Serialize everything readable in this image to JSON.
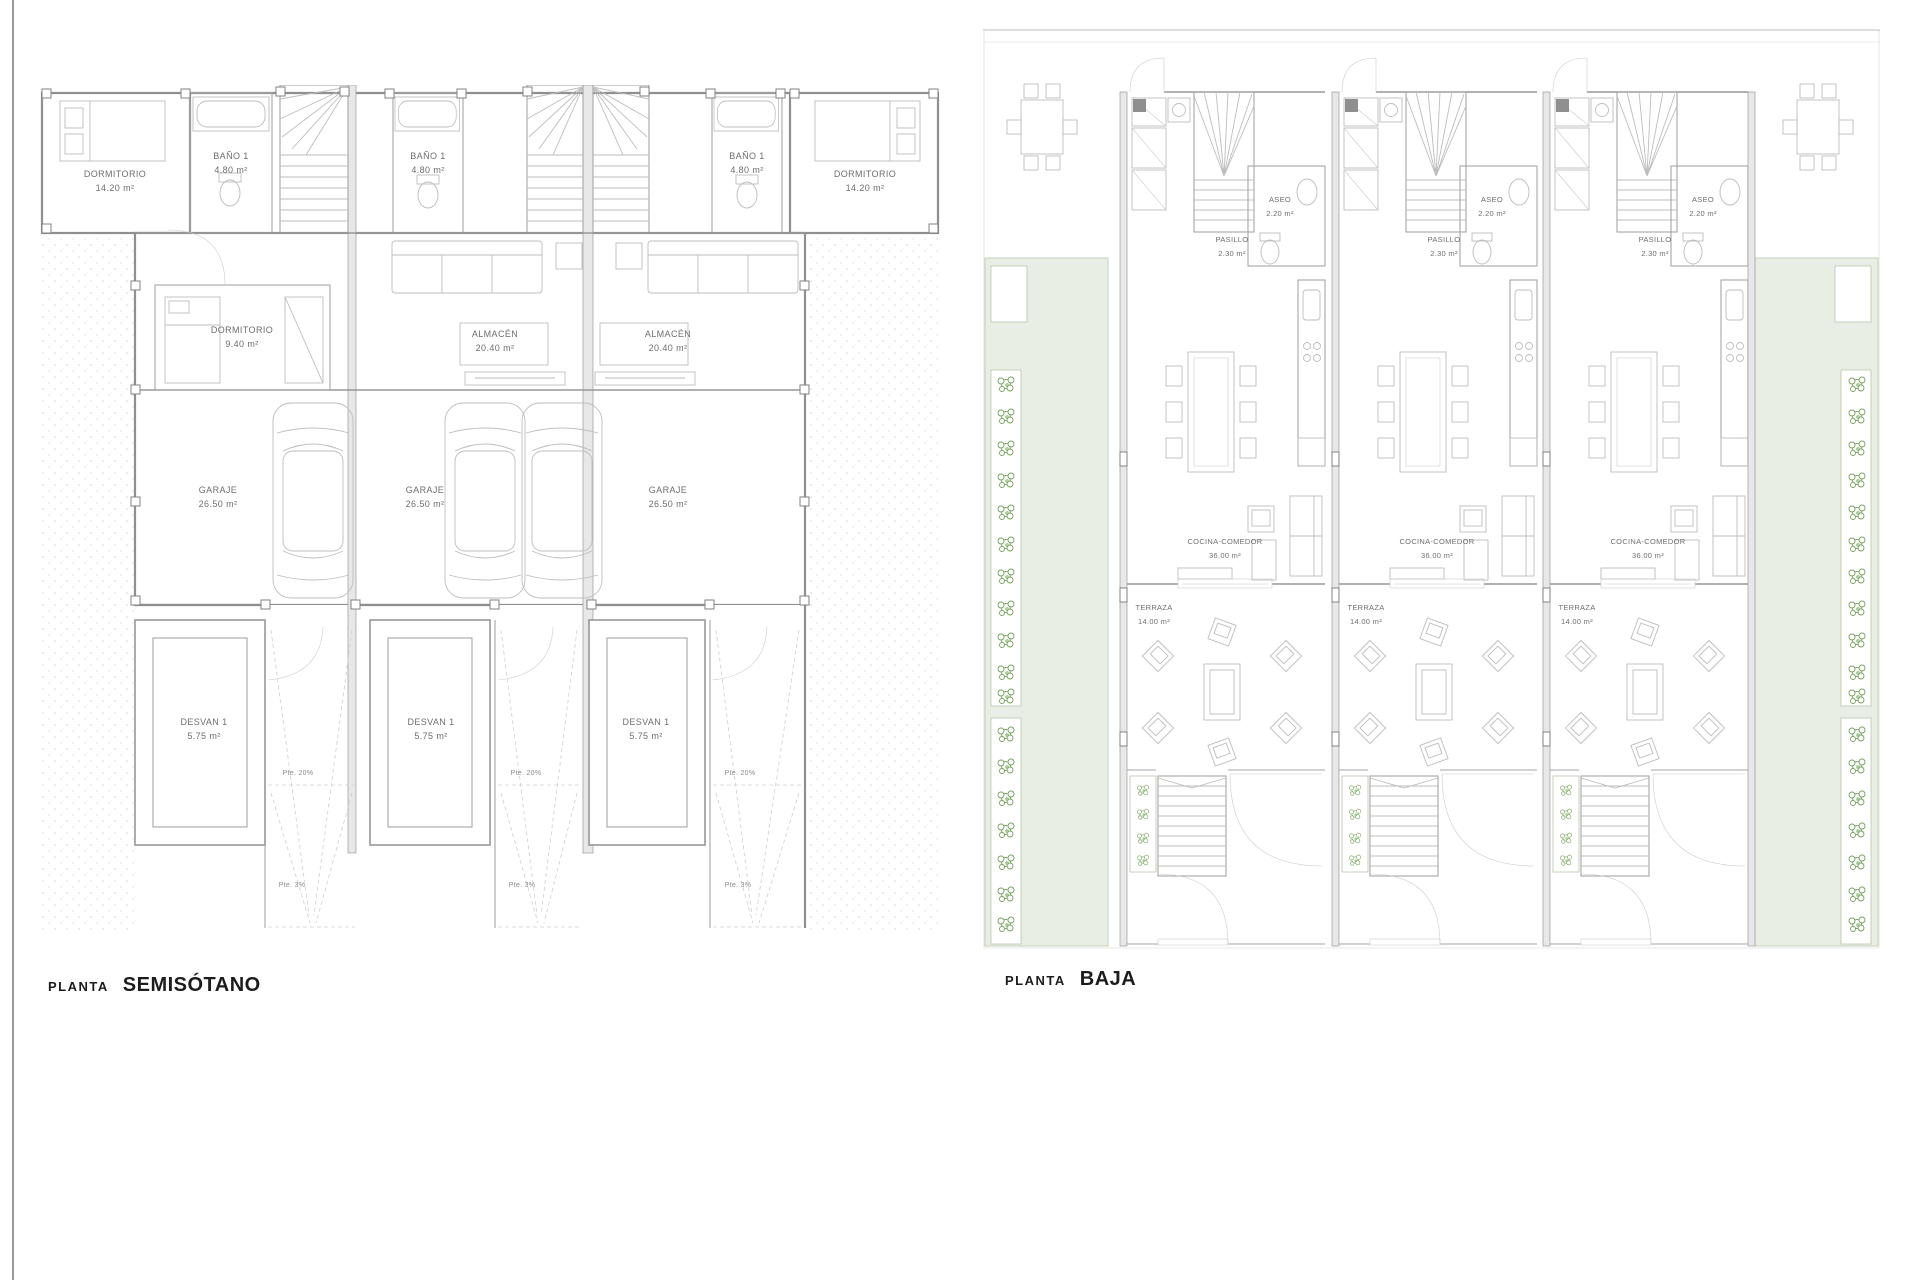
{
  "titles": {
    "left": {
      "prefix": "PLANTA",
      "name": "SEMISÓTANO"
    },
    "right": {
      "prefix": "PLANTA",
      "name": "BAJA"
    }
  },
  "semisotano": {
    "dormitorio_wing": {
      "name": "DORMITORIO",
      "area": "14.20 m²"
    },
    "bano": {
      "name": "BAÑO 1",
      "area": "4.80 m²"
    },
    "dormitorio_small": {
      "name": "DORMITORIO",
      "area": "9.40 m²"
    },
    "almacen": {
      "name": "ALMACÉN",
      "area": "20.40 m²"
    },
    "garaje": {
      "name": "GARAJE",
      "area": "26.50 m²"
    },
    "desvan": {
      "name": "DESVAN 1",
      "area": "5.75 m²"
    },
    "ramp_slope": "Pte. 20%",
    "ramp_slope_low": "Pte. 3%"
  },
  "baja": {
    "aseo": {
      "name": "ASEO",
      "area": "2.20 m²"
    },
    "pasillo": {
      "name": "PASILLO",
      "area": "2.30 m²"
    },
    "cocina": {
      "name": "COCINA-COMEDOR",
      "area": "36.00 m²"
    },
    "terraza": {
      "name": "TERRAZA",
      "area": "14.00 m²"
    }
  },
  "colors": {
    "wall": "#8f8f8f",
    "furniture": "#bdbdbd",
    "label_text": "#6e6e6e",
    "title_text": "#1c1c1c",
    "garden_fill": "#e9eee4",
    "plant_green": "#74a25c",
    "page_border": "#9b9b9b"
  }
}
